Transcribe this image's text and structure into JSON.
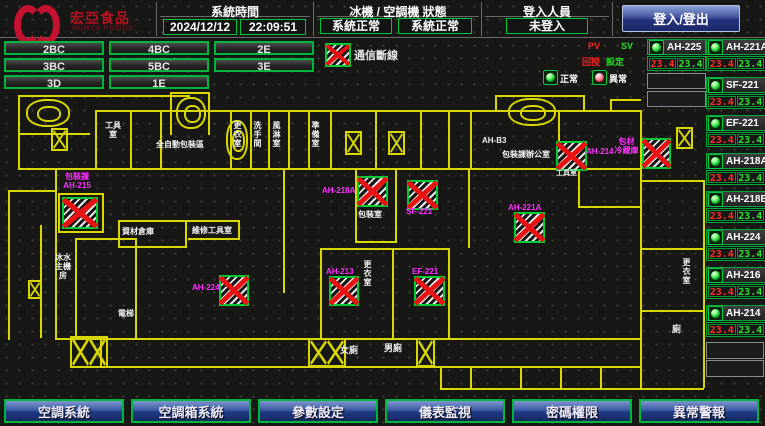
{
  "header": {
    "brand": "宏亞食品",
    "brand_sub": "HUNYA FOODS",
    "time_label": "系統時間",
    "date": "2024/12/12",
    "time": "22:09:51",
    "status_label": "冰機 / 空調機 狀態",
    "chiller_status": "系統正常",
    "ahu_status": "系統正常",
    "login_label": "登入人員",
    "login_value": "未登入",
    "login_button": "登入/登出"
  },
  "floors": [
    "2BC",
    "4BC",
    "2E",
    "3BC",
    "5BC",
    "3E",
    "3D",
    "1E"
  ],
  "legend": {
    "comm_fail": "通信斷線",
    "pv": "PV",
    "sv": "SV",
    "pv_sub": "回授",
    "sv_sub": "設定",
    "normal": "正常",
    "abnormal": "異常"
  },
  "units_left": [
    {
      "name": "AH-225",
      "pv": "23.4",
      "sv": "23.4"
    }
  ],
  "units_right": [
    {
      "name": "AH-221A",
      "pv": "23.4",
      "sv": "23.4"
    },
    {
      "name": "SF-221",
      "pv": "23.4",
      "sv": "23.4"
    },
    {
      "name": "EF-221",
      "pv": "23.4",
      "sv": "23.4"
    },
    {
      "name": "AH-218A",
      "pv": "23.4",
      "sv": "23.4"
    },
    {
      "name": "AH-218B",
      "pv": "23.4",
      "sv": "23.4"
    },
    {
      "name": "AH-224",
      "pv": "23.4",
      "sv": "23.4"
    },
    {
      "name": "AH-216",
      "pv": "23.4",
      "sv": "23.4"
    },
    {
      "name": "AH-214",
      "pv": "23.4",
      "sv": "23.4"
    }
  ],
  "nav": [
    "空調系統",
    "空調箱系統",
    "參數設定",
    "儀表監視",
    "密碼權限",
    "異常警報"
  ],
  "map": {
    "markers": [
      {
        "line1": "包裝課",
        "line2": "AH-215"
      },
      {
        "name": "AH-218A"
      },
      {
        "name": "SF-221"
      },
      {
        "name": "AH-214"
      },
      {
        "line1": "包材",
        "line2": "冷藏庫"
      },
      {
        "name": "AH-221A"
      },
      {
        "name": "AH-213"
      },
      {
        "name": "EF-221"
      },
      {
        "name": "AH-224"
      }
    ],
    "rooms": [
      "工具室",
      "全自動包裝區",
      "更衣室",
      "洗手間",
      "風淋室",
      "準備室",
      "AH-B3",
      "包裝課辦公室",
      "資材倉庫",
      "維修工具室",
      "包裝室",
      "更衣室",
      "女廁",
      "男廁",
      "冰水主機房",
      "電梯",
      "更衣室",
      "廁",
      "工具室"
    ]
  }
}
